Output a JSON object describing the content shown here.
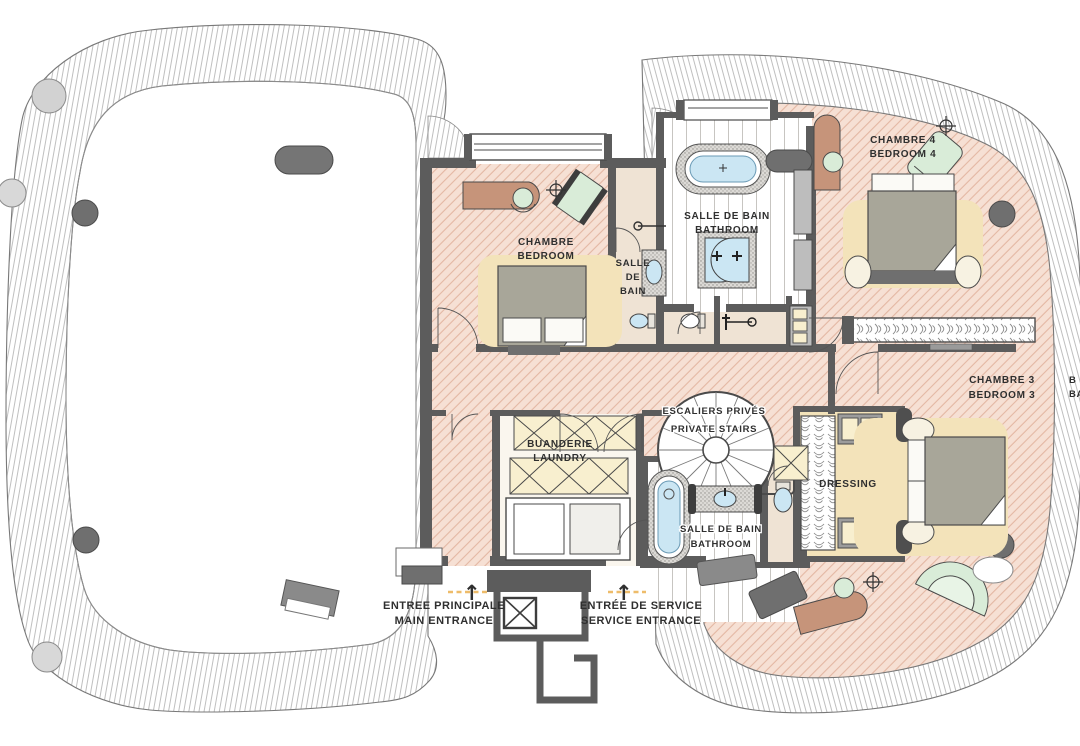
{
  "palette": {
    "wall": "#5c5c5c",
    "bedroom_floor": "#f6e0d4",
    "floor_hatch": "#dfb3a0",
    "rug_cream": "#f3e3ba",
    "wood_brown": "#c6947a",
    "seating_green": "#d9ecd8",
    "water_blue": "#cbe6f3",
    "tile_stipple": "#dcdad6",
    "cabinet_cream": "#f8efcf",
    "band_line": "#9a9a9a",
    "label_ink": "#2f2f2f",
    "threshold_dash": "#eebc6a",
    "duvet_gray": "#a8a699",
    "column_gray": "#6f6f6f"
  },
  "labels": {
    "bedroom_left": {
      "fr": "CHAMBRE",
      "en": "BEDROOM"
    },
    "ensuite_bath": {
      "l1": "SALLE",
      "l2": "DE",
      "l3": "BAIN"
    },
    "master_bath": {
      "fr": "SALLE DE BAIN",
      "en": "BATHROOM"
    },
    "bedroom4": {
      "fr": "CHAMBRE 4",
      "en": "BEDROOM 4"
    },
    "bedroom3": {
      "fr": "CHAMBRE 3",
      "en": "BEDROOM 3"
    },
    "laundry": {
      "fr": "BUANDERIE",
      "en": "LAUNDRY"
    },
    "private_stairs": {
      "fr": "ESCALIERS PRIVÉS",
      "en": "PRIVATE STAIRS"
    },
    "dressing": {
      "fr": "DRESSING"
    },
    "guest_bath": {
      "fr": "SALLE DE BAIN",
      "en": "BATHROOM"
    },
    "balcony_clipped": {
      "l1": "B",
      "l2": "BA"
    },
    "main_entrance": {
      "fr": "ENTREE PRINCIPALE",
      "en": "MAIN ENTRANCE"
    },
    "service_entrance": {
      "fr": "ENTRÉE DE SERVICE",
      "en": "SERVICE ENTRANCE"
    }
  },
  "icons": {
    "up_arrow": "↑"
  }
}
